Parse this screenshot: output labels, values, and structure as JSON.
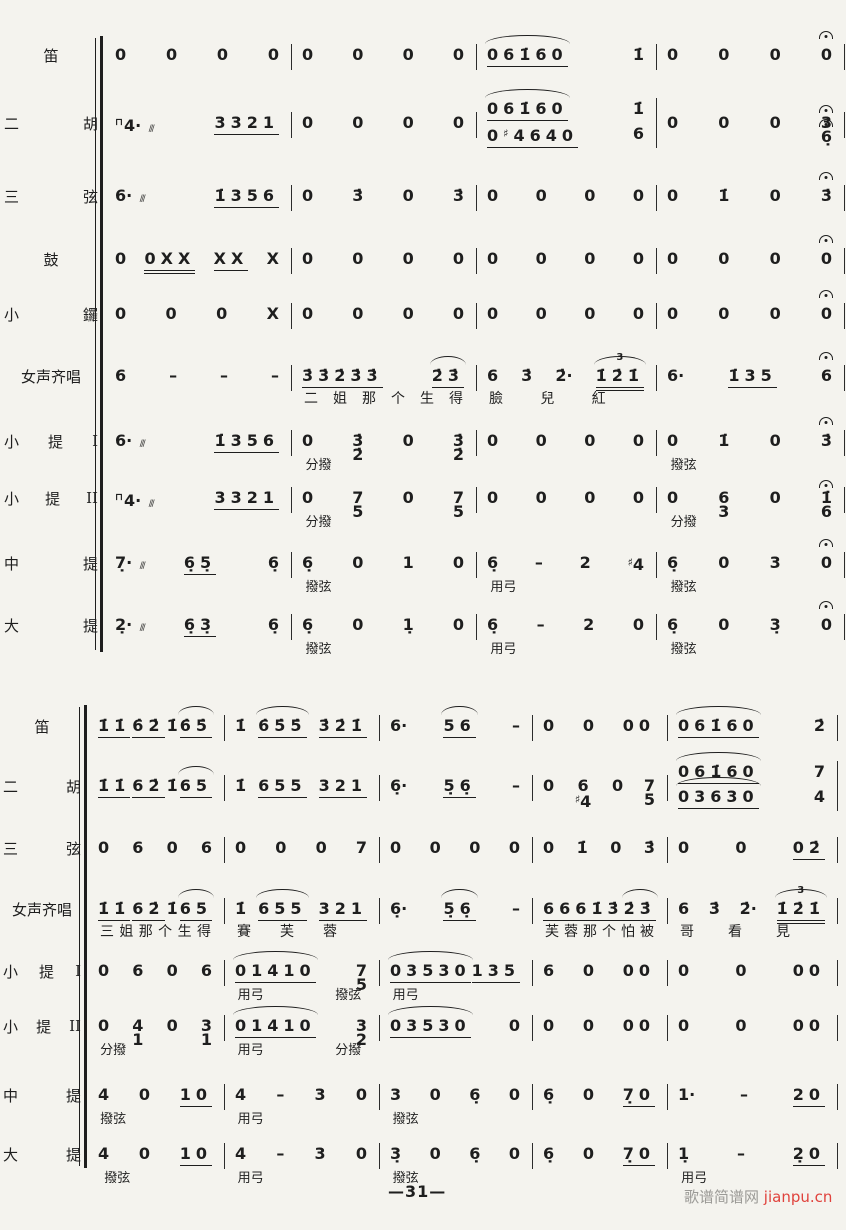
{
  "page": {
    "number": "—31—",
    "watermark": {
      "site": "歌谱简谱网",
      "domain": "jianpu.cn"
    }
  },
  "systems": [
    {
      "rows": [
        {
          "label": "笛",
          "measures": [
            {
              "b": [
                "0",
                "0",
                "0",
                "0"
              ]
            },
            {
              "b": [
                "0",
                "0",
                "0",
                "0"
              ]
            },
            {
              "b": [
                {
                  "n": "061̇60",
                  "arc": true
                },
                "1̇"
              ]
            },
            {
              "b": [
                "0",
                "0",
                "0",
                "0^"
              ]
            }
          ]
        },
        {
          "label": "二 胡",
          "measures": [
            {
              "b": [
                "⊓4·*",
                "3321"
              ]
            },
            {
              "b": [
                "0",
                "0",
                "0",
                "0"
              ]
            },
            {
              "lines": [
                [
                  {
                    "n": "061̇60",
                    "arc": true
                  },
                  "1̇"
                ],
                [
                  {
                    "n": "0♯4640"
                  },
                  "6"
                ]
              ]
            },
            {
              "b": [
                "0",
                "0",
                "0",
                "3^/6̣^"
              ]
            }
          ]
        },
        {
          "label": "三 弦",
          "measures": [
            {
              "b": [
                "6·*",
                "1̇356"
              ]
            },
            {
              "b": [
                "0",
                "3̇",
                "0",
                "3̇"
              ]
            },
            {
              "b": [
                "0",
                "0",
                "0",
                "0"
              ]
            },
            {
              "b": [
                "0",
                "1̇",
                "0",
                "3̇^"
              ]
            }
          ]
        },
        {
          "label": "鼓",
          "measures": [
            {
              "b": [
                "0",
                {
                  "n": "0XX",
                  "u": 2
                },
                "XX",
                "X"
              ]
            },
            {
              "b": [
                "0",
                "0",
                "0",
                "0"
              ]
            },
            {
              "b": [
                "0",
                "0",
                "0",
                "0"
              ]
            },
            {
              "b": [
                "0",
                "0",
                "0",
                "0^"
              ]
            }
          ]
        },
        {
          "label": "小 鑼",
          "measures": [
            {
              "b": [
                "0",
                "0",
                "0",
                "X"
              ]
            },
            {
              "b": [
                "0",
                "0",
                "0",
                "0"
              ]
            },
            {
              "b": [
                "0",
                "0",
                "0",
                "0"
              ]
            },
            {
              "b": [
                "0",
                "0",
                "0",
                "0^"
              ]
            }
          ]
        },
        {
          "label": "女声齐唱",
          "measures": [
            {
              "b": [
                "6",
                "–",
                "–",
                "–"
              ]
            },
            {
              "b": [
                "3̇3̇2̇3̇3̇",
                "~2̇3̇"
              ],
              "lyr": [
                "二",
                "姐",
                "那",
                "个",
                "生",
                "得"
              ]
            },
            {
              "b": [
                "6",
                "3̇",
                "2̇·",
                {
                  "n": "1̇2̇1̇",
                  "u": 2,
                  "tuplet": "3",
                  "arc": true
                }
              ],
              "lyr": [
                "臉",
                "兒",
                "紅",
                ""
              ]
            },
            {
              "b": [
                "6·",
                "1̇35",
                "6^"
              ]
            }
          ]
        },
        {
          "label": "小 提 I",
          "measures": [
            {
              "b": [
                "6·*",
                "1̇356"
              ]
            },
            {
              "b": [
                "0",
                "3̇/2̇",
                "0",
                "3̇/2̇"
              ],
              "ann": [
                {
                  "t": "分撥",
                  "x": 0.03
                }
              ]
            },
            {
              "b": [
                "0",
                "0",
                "0",
                "0"
              ]
            },
            {
              "b": [
                "0",
                "1̇",
                "0",
                "3̇^"
              ],
              "ann": [
                {
                  "t": "撥弦",
                  "x": 0.03
                }
              ]
            }
          ]
        },
        {
          "label": "小 提 II",
          "measures": [
            {
              "b": [
                "⊓4·*",
                "3321"
              ]
            },
            {
              "b": [
                "0",
                "7/5",
                "0",
                "7/5"
              ],
              "ann": [
                {
                  "t": "分撥",
                  "x": 0.03
                }
              ]
            },
            {
              "b": [
                "0",
                "0",
                "0",
                "0"
              ]
            },
            {
              "b": [
                "0",
                "6/3",
                "0",
                "1̇^/6"
              ],
              "ann": [
                {
                  "t": "分撥",
                  "x": 0.03
                }
              ]
            }
          ]
        },
        {
          "label": "中 提",
          "measures": [
            {
              "b": [
                "7̣·*",
                "6̣5̣",
                "6̣"
              ]
            },
            {
              "b": [
                "6̣",
                "0",
                "1",
                "0"
              ],
              "ann": [
                {
                  "t": "撥弦",
                  "x": 0.03
                }
              ]
            },
            {
              "b": [
                "6̣",
                "–",
                "2",
                "♯4"
              ],
              "ann": [
                {
                  "t": "用弓",
                  "x": 0.03
                }
              ]
            },
            {
              "b": [
                "6̣",
                "0",
                "3",
                "0^"
              ],
              "ann": [
                {
                  "t": "撥弦",
                  "x": 0.03
                }
              ]
            }
          ]
        },
        {
          "label": "大 提",
          "measures": [
            {
              "b": [
                "2̣·*",
                "6̣3̣",
                "6̣"
              ]
            },
            {
              "b": [
                "6̣",
                "0",
                "1̣",
                "0"
              ],
              "ann": [
                {
                  "t": "撥弦",
                  "x": 0.03
                }
              ]
            },
            {
              "b": [
                "6̣",
                "–",
                "2",
                "0"
              ],
              "ann": [
                {
                  "t": "用弓",
                  "x": 0.03
                }
              ]
            },
            {
              "b": [
                "6̣",
                "0",
                "3̣",
                "0^"
              ],
              "ann": [
                {
                  "t": "撥弦",
                  "x": 0.03
                }
              ]
            }
          ]
        }
      ]
    },
    {
      "rows": [
        {
          "label": "笛",
          "measures": [
            {
              "b": [
                "1̇1̇",
                "6̇2̇",
                "1̇",
                "~6̇5̇"
              ]
            },
            {
              "b": [
                "1̇",
                "~6̇5̇5̇",
                "3̇2̇1̇"
              ]
            },
            {
              "b": [
                "6·",
                "~56",
                "–"
              ]
            },
            {
              "b": [
                "0",
                "0",
                "00"
              ]
            },
            {
              "b": [
                {
                  "n": "061̇60",
                  "arc": true
                },
                "2̇"
              ]
            }
          ]
        },
        {
          "label": "二 胡",
          "measures": [
            {
              "b": [
                "1̇1̇",
                "62̇",
                "1̇",
                "~65"
              ]
            },
            {
              "b": [
                "1̇",
                "655",
                "321"
              ]
            },
            {
              "b": [
                "6̣·",
                "5̣6̣",
                "–"
              ]
            },
            {
              "b": [
                "0",
                "6/♯4",
                "0",
                "7/5"
              ]
            },
            {
              "lines": [
                [
                  {
                    "n": "061̇60",
                    "arc": true
                  },
                  "7"
                ],
                [
                  {
                    "n": "03630",
                    "arc": true
                  },
                  "4"
                ]
              ]
            }
          ]
        },
        {
          "label": "三 弦",
          "measures": [
            {
              "b": [
                "0",
                "6",
                "0",
                "6"
              ]
            },
            {
              "b": [
                "0",
                "0",
                "0",
                "7"
              ]
            },
            {
              "b": [
                "0",
                "0",
                "0",
                "0"
              ]
            },
            {
              "b": [
                "0",
                "1̇",
                "0",
                "3̇"
              ]
            },
            {
              "b": [
                "0",
                "0",
                "02̇"
              ]
            }
          ]
        },
        {
          "label": "女声齐唱",
          "measures": [
            {
              "b": [
                "1̇1̇",
                "62̇",
                "1̇",
                "~65"
              ],
              "lyr": [
                "三",
                "姐",
                "那",
                "个",
                "生",
                "得"
              ]
            },
            {
              "b": [
                "1̇",
                "~655",
                "321"
              ],
              "lyr": [
                "賽",
                "芙",
                "蓉",
                ""
              ]
            },
            {
              "b": [
                "6̣·",
                "~5̣6̣",
                "–"
              ]
            },
            {
              "b": [
                {
                  "n": "6661̇3̇"
                },
                "~2̇3̇"
              ],
              "lyr": [
                "芙",
                "蓉",
                "那",
                "个",
                "怕",
                "被"
              ]
            },
            {
              "b": [
                "6",
                "3̇",
                "2̇·",
                {
                  "n": "1̇2̇1̇",
                  "u": 2,
                  "tuplet": "3",
                  "arc": true
                }
              ],
              "lyr": [
                "哥",
                "看",
                "見",
                ""
              ]
            }
          ]
        },
        {
          "label": "小 提 I",
          "measures": [
            {
              "b": [
                "0",
                "6",
                "0",
                "6"
              ]
            },
            {
              "b": [
                {
                  "n": "01410",
                  "arc": true
                },
                "7/5"
              ],
              "ann": [
                {
                  "t": "用弓",
                  "x": 0.03
                },
                {
                  "t": "撥弦",
                  "x": 0.66
                }
              ]
            },
            {
              "b": [
                {
                  "n": "03530",
                  "arc": true
                },
                {
                  "n": "135"
                }
              ],
              "ann": [
                {
                  "t": "用弓",
                  "x": 0.03
                }
              ]
            },
            {
              "b": [
                "6",
                "0",
                "00"
              ]
            },
            {
              "b": [
                "0",
                "0",
                "00"
              ]
            }
          ]
        },
        {
          "label": "小 提 II",
          "measures": [
            {
              "b": [
                "0",
                "4/1",
                "0",
                "3/1"
              ],
              "ann": [
                {
                  "t": "分撥",
                  "x": 0.03
                }
              ]
            },
            {
              "b": [
                {
                  "n": "01410",
                  "arc": true
                },
                "3/2"
              ],
              "ann": [
                {
                  "t": "用弓",
                  "x": 0.03
                },
                {
                  "t": "分撥",
                  "x": 0.66
                }
              ]
            },
            {
              "b": [
                {
                  "n": "03530",
                  "arc": true
                },
                "0"
              ]
            },
            {
              "b": [
                "0",
                "0",
                "00"
              ]
            },
            {
              "b": [
                "0",
                "0",
                "00"
              ]
            }
          ]
        },
        {
          "label": "中 提",
          "measures": [
            {
              "b": [
                "4",
                "0",
                "10"
              ],
              "ann": [
                {
                  "t": "撥弦",
                  "x": 0.03
                }
              ]
            },
            {
              "b": [
                "4",
                "–",
                "3",
                "0"
              ],
              "ann": [
                {
                  "t": "用弓",
                  "x": 0.03
                }
              ]
            },
            {
              "b": [
                "3",
                "0",
                "6̣",
                "0"
              ],
              "ann": [
                {
                  "t": "撥弦",
                  "x": 0.03
                }
              ]
            },
            {
              "b": [
                "6̣",
                "0",
                "7̣0"
              ]
            },
            {
              "b": [
                "1·",
                "–",
                "20"
              ]
            }
          ]
        },
        {
          "label": "大 提",
          "measures": [
            {
              "b": [
                "4",
                "0",
                "10"
              ],
              "ann": [
                {
                  "t": "撥弦",
                  "x": 0.06
                }
              ]
            },
            {
              "b": [
                "4",
                "–",
                "3",
                "0"
              ],
              "ann": [
                {
                  "t": "用弓",
                  "x": 0.03
                }
              ]
            },
            {
              "b": [
                "3̣",
                "0",
                "6̣",
                "0"
              ],
              "ann": [
                {
                  "t": "撥弦",
                  "x": 0.03
                }
              ]
            },
            {
              "b": [
                "6̣",
                "0",
                "7̣0"
              ]
            },
            {
              "b": [
                "1̣",
                "–",
                "2̣0"
              ],
              "ann": [
                {
                  "t": "用弓",
                  "x": 0.03
                }
              ]
            }
          ]
        }
      ]
    }
  ]
}
